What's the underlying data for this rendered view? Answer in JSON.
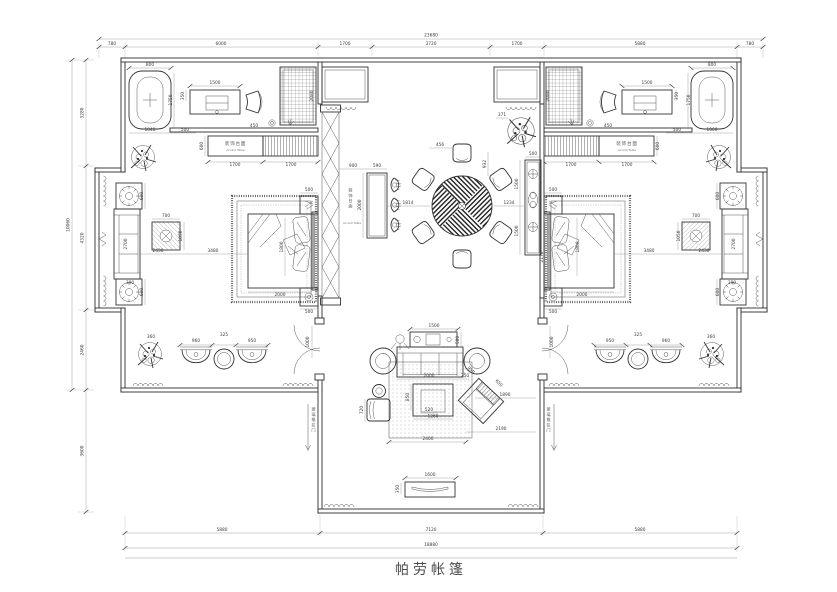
{
  "title": {
    "text": "帕劳帐篷"
  },
  "labels": {
    "accent_table_cn": "装饰台面",
    "accent_table_en": "Accent Table",
    "bar_table_cn": "装饰台面",
    "bar_table_en": "Accent Table",
    "sliding_door_note": "玻璃推拉门"
  },
  "colors": {
    "line": "#333333",
    "wall": "#2d2d2d",
    "dim_text": "#3a3a3a",
    "background": "#ffffff",
    "title_text": "#4a4a4a"
  },
  "dimension_lines": {
    "top": {
      "total": "23680",
      "segments": [
        "780",
        "6000",
        "1700",
        "3720",
        "1700",
        "5880",
        "780"
      ]
    },
    "left": {
      "total": "10060",
      "segments": [
        "3280",
        "4320",
        "2460",
        "3600"
      ]
    },
    "bottom": {
      "total": "18880",
      "segments": [
        "5880",
        "7120",
        "5880"
      ]
    }
  },
  "dim_labels": [
    {
      "t": "23680",
      "x": 431,
      "y": 36.5
    },
    {
      "t": "780",
      "x": 112,
      "y": 45
    },
    {
      "t": "6000",
      "x": 221,
      "y": 45
    },
    {
      "t": "1700",
      "x": 345,
      "y": 45
    },
    {
      "t": "3720",
      "x": 431,
      "y": 45
    },
    {
      "t": "1700",
      "x": 517,
      "y": 45
    },
    {
      "t": "5880",
      "x": 640,
      "y": 45
    },
    {
      "t": "780",
      "x": 750,
      "y": 45
    },
    {
      "t": "10060",
      "x": 69.5,
      "y": 225,
      "r": -90
    },
    {
      "t": "3280",
      "x": 83.5,
      "y": 113,
      "r": -90
    },
    {
      "t": "4320",
      "x": 83.5,
      "y": 238,
      "r": -90
    },
    {
      "t": "2460",
      "x": 83.5,
      "y": 350,
      "r": -90
    },
    {
      "t": "3600",
      "x": 83.5,
      "y": 451,
      "r": -90
    },
    {
      "t": "5880",
      "x": 222,
      "y": 531
    },
    {
      "t": "7120",
      "x": 431,
      "y": 531
    },
    {
      "t": "5880",
      "x": 640,
      "y": 531
    },
    {
      "t": "18880",
      "x": 431,
      "y": 546
    },
    {
      "t": "800",
      "x": 150,
      "y": 66
    },
    {
      "t": "1750",
      "x": 172,
      "y": 100,
      "r": -90
    },
    {
      "t": "1040",
      "x": 150,
      "y": 131
    },
    {
      "t": "500",
      "x": 185,
      "y": 131
    },
    {
      "t": "350",
      "x": 184,
      "y": 96,
      "r": -90
    },
    {
      "t": "1500",
      "x": 215,
      "y": 84
    },
    {
      "t": "450",
      "x": 254,
      "y": 127
    },
    {
      "t": "2080",
      "x": 313,
      "y": 96,
      "r": -90
    },
    {
      "t": "600",
      "x": 203,
      "y": 146,
      "r": -90
    },
    {
      "t": "1700",
      "x": 235,
      "y": 166
    },
    {
      "t": "1700",
      "x": 291,
      "y": 166
    },
    {
      "t": "500",
      "x": 309,
      "y": 191
    },
    {
      "t": "500",
      "x": 309,
      "y": 313
    },
    {
      "t": "1800",
      "x": 283,
      "y": 247,
      "r": -90
    },
    {
      "t": "2000",
      "x": 280,
      "y": 296
    },
    {
      "t": "700",
      "x": 166,
      "y": 217
    },
    {
      "t": "1050",
      "x": 182,
      "y": 236,
      "r": -90
    },
    {
      "t": "2430",
      "x": 158,
      "y": 252
    },
    {
      "t": "3480",
      "x": 213,
      "y": 252
    },
    {
      "t": "2700",
      "x": 127,
      "y": 244,
      "r": -90
    },
    {
      "t": "600",
      "x": 143,
      "y": 196,
      "r": -90
    },
    {
      "t": "600",
      "x": 143,
      "y": 292,
      "r": -90
    },
    {
      "t": "390",
      "x": 130,
      "y": 284
    },
    {
      "t": "360",
      "x": 151,
      "y": 338
    },
    {
      "t": "960",
      "x": 196,
      "y": 342
    },
    {
      "t": "325",
      "x": 224,
      "y": 336
    },
    {
      "t": "950",
      "x": 252,
      "y": 342
    },
    {
      "t": "1000",
      "x": 309,
      "y": 342,
      "r": -90
    },
    {
      "t": "900",
      "x": 353,
      "y": 167
    },
    {
      "t": "590",
      "x": 377,
      "y": 167
    },
    {
      "t": "2000",
      "x": 361,
      "y": 205,
      "r": -90
    },
    {
      "t": "1814",
      "x": 408,
      "y": 204
    },
    {
      "t": "456",
      "x": 440,
      "y": 146
    },
    {
      "t": "932",
      "x": 486,
      "y": 164,
      "r": -90
    },
    {
      "t": "1234",
      "x": 509,
      "y": 204
    },
    {
      "t": "371",
      "x": 502,
      "y": 116
    },
    {
      "t": "500",
      "x": 533,
      "y": 155
    },
    {
      "t": "1500",
      "x": 518,
      "y": 184,
      "r": -90
    },
    {
      "t": "1500",
      "x": 518,
      "y": 231,
      "r": -90
    },
    {
      "t": "2170",
      "x": 543,
      "y": 257,
      "r": -90
    },
    {
      "t": "1500",
      "x": 434,
      "y": 327
    },
    {
      "t": "500",
      "x": 459,
      "y": 340,
      "r": -90
    },
    {
      "t": "2000",
      "x": 429,
      "y": 377
    },
    {
      "t": "250",
      "x": 465,
      "y": 377
    },
    {
      "t": "850",
      "x": 409,
      "y": 397,
      "r": -90
    },
    {
      "t": "520",
      "x": 429,
      "y": 411
    },
    {
      "t": "1260",
      "x": 433,
      "y": 417.5
    },
    {
      "t": "720",
      "x": 363,
      "y": 410,
      "r": -90
    },
    {
      "t": "650",
      "x": 498,
      "y": 384,
      "r": 45
    },
    {
      "t": "950",
      "x": 470,
      "y": 371,
      "r": 45
    },
    {
      "t": "1890",
      "x": 505,
      "y": 396
    },
    {
      "t": "2190",
      "x": 501,
      "y": 430
    },
    {
      "t": "2400",
      "x": 428,
      "y": 440
    },
    {
      "t": "1600",
      "x": 430,
      "y": 476
    },
    {
      "t": "350",
      "x": 399,
      "y": 489,
      "r": -90
    },
    {
      "t": "800",
      "x": 712,
      "y": 66
    },
    {
      "t": "1750",
      "x": 690,
      "y": 100,
      "r": -90
    },
    {
      "t": "1000",
      "x": 712,
      "y": 131
    },
    {
      "t": "500",
      "x": 677,
      "y": 131
    },
    {
      "t": "350",
      "x": 678,
      "y": 96,
      "r": -90
    },
    {
      "t": "1500",
      "x": 647,
      "y": 84
    },
    {
      "t": "450",
      "x": 608,
      "y": 127
    },
    {
      "t": "2080",
      "x": 549,
      "y": 96,
      "r": -90
    },
    {
      "t": "600",
      "x": 659,
      "y": 146,
      "r": -90
    },
    {
      "t": "1700",
      "x": 571,
      "y": 166
    },
    {
      "t": "1700",
      "x": 627,
      "y": 166
    },
    {
      "t": "500",
      "x": 553,
      "y": 191
    },
    {
      "t": "500",
      "x": 553,
      "y": 313
    },
    {
      "t": "1800",
      "x": 579,
      "y": 247,
      "r": -90
    },
    {
      "t": "2000",
      "x": 582,
      "y": 296
    },
    {
      "t": "700",
      "x": 696,
      "y": 217
    },
    {
      "t": "1050",
      "x": 680,
      "y": 236,
      "r": -90
    },
    {
      "t": "2430",
      "x": 704,
      "y": 252
    },
    {
      "t": "3480",
      "x": 649,
      "y": 252
    },
    {
      "t": "2700",
      "x": 735,
      "y": 244,
      "r": -90
    },
    {
      "t": "600",
      "x": 719,
      "y": 196,
      "r": -90
    },
    {
      "t": "600",
      "x": 719,
      "y": 292,
      "r": -90
    },
    {
      "t": "390",
      "x": 732,
      "y": 284
    },
    {
      "t": "360",
      "x": 711,
      "y": 338
    },
    {
      "t": "960",
      "x": 666,
      "y": 342
    },
    {
      "t": "325",
      "x": 638,
      "y": 336
    },
    {
      "t": "950",
      "x": 610,
      "y": 342
    },
    {
      "t": "1000",
      "x": 553,
      "y": 342,
      "r": -90
    }
  ]
}
